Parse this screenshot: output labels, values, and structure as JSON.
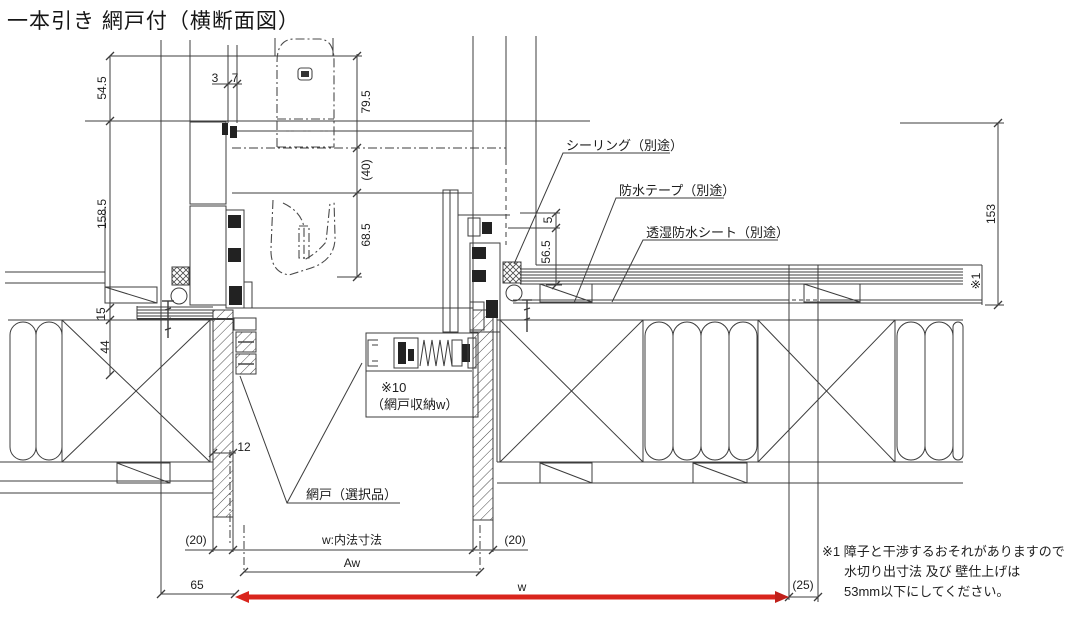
{
  "title": "一本引き 網戸付（横断面図）",
  "colors": {
    "line": "#3c3c3c",
    "red": "#d9251d",
    "text": "#1c1c1c",
    "background": "#ffffff"
  },
  "dims": {
    "v54_5": "54.5",
    "h3": "3",
    "h7": "7",
    "v79_5": "79.5",
    "v40": "(40)",
    "v158_5": "158.5",
    "v68_5": "68.5",
    "v5": "5",
    "v56_5": "56.5",
    "v153": "153",
    "v15": "15",
    "v44": "44",
    "h12": "12",
    "h65": "65",
    "h20_left": "(20)",
    "h20_right": "(20)",
    "h25": "(25)",
    "w_inner": "w:内法寸法",
    "aw": "Aw",
    "w": "w",
    "ref_wall": "※1"
  },
  "callouts": {
    "sealing": "シーリング（別途）",
    "tape": "防水テープ（別途）",
    "sheet": "透湿防水シート（別途）",
    "pocket_ref": "※10",
    "pocket_label": "（網戸収納w）",
    "screen": "網戸（選択品）"
  },
  "note": {
    "line1": "※1 障子と干渉するおそれがありますので",
    "line2": "水切り出寸法 及び 壁仕上げは",
    "line3": "53mm以下にしてください。"
  }
}
